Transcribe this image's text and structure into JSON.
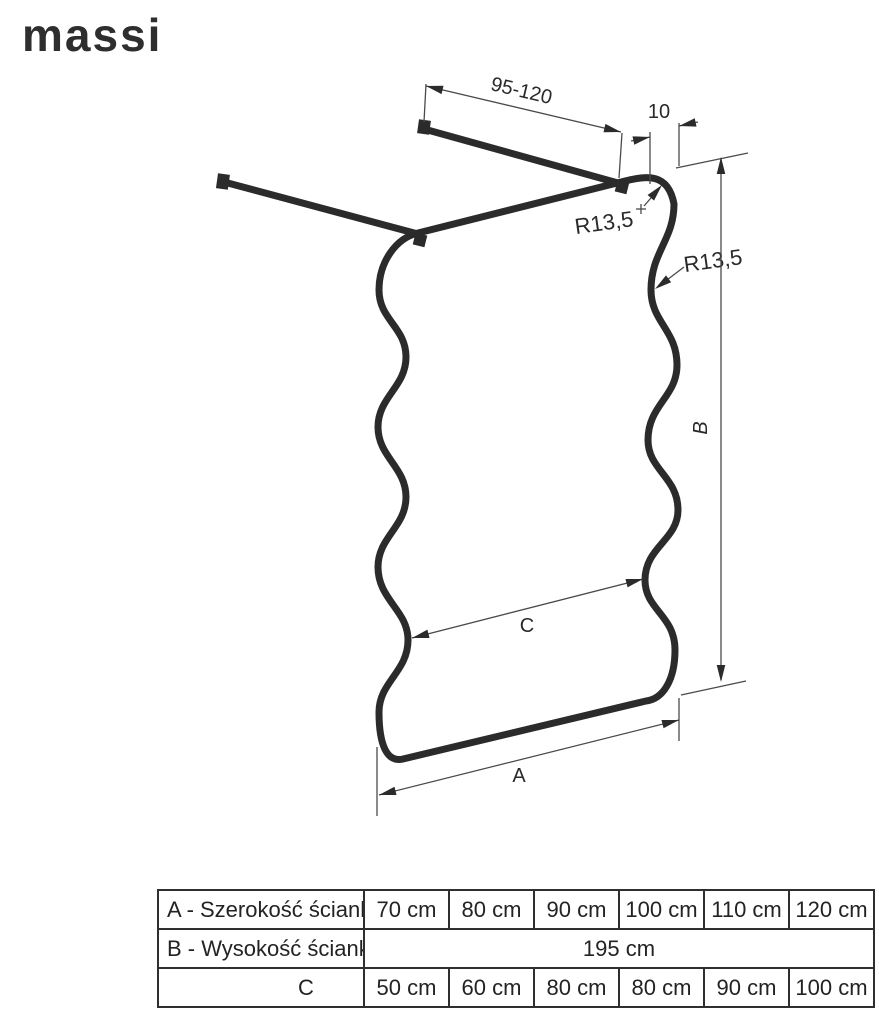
{
  "brand": {
    "logo_text": "massi"
  },
  "colors": {
    "ink": "#2b2b2b",
    "dim_line": "#4a4a4a",
    "text": "#2a2a2a",
    "table_border": "#2f2f2f",
    "background": "#ffffff"
  },
  "diagram": {
    "labels": {
      "bar_length_range": "95-120",
      "wall_offset": "10",
      "corner_radius_top": "R13,5",
      "corner_radius_side": "R13,5",
      "height_label": "B",
      "inner_width_label": "C",
      "width_label": "A"
    }
  },
  "table": {
    "rows": [
      {
        "label": "A - Szerokość ścianki",
        "values": [
          "70 cm",
          "80 cm",
          "90 cm",
          "100 cm",
          "110 cm",
          "120 cm"
        ]
      },
      {
        "label": "B - Wysokość ścianki",
        "merged_value": "195 cm"
      },
      {
        "label": "C",
        "values": [
          "50 cm",
          "60 cm",
          "80 cm",
          "80 cm",
          "90 cm",
          "100 cm"
        ]
      }
    ]
  }
}
